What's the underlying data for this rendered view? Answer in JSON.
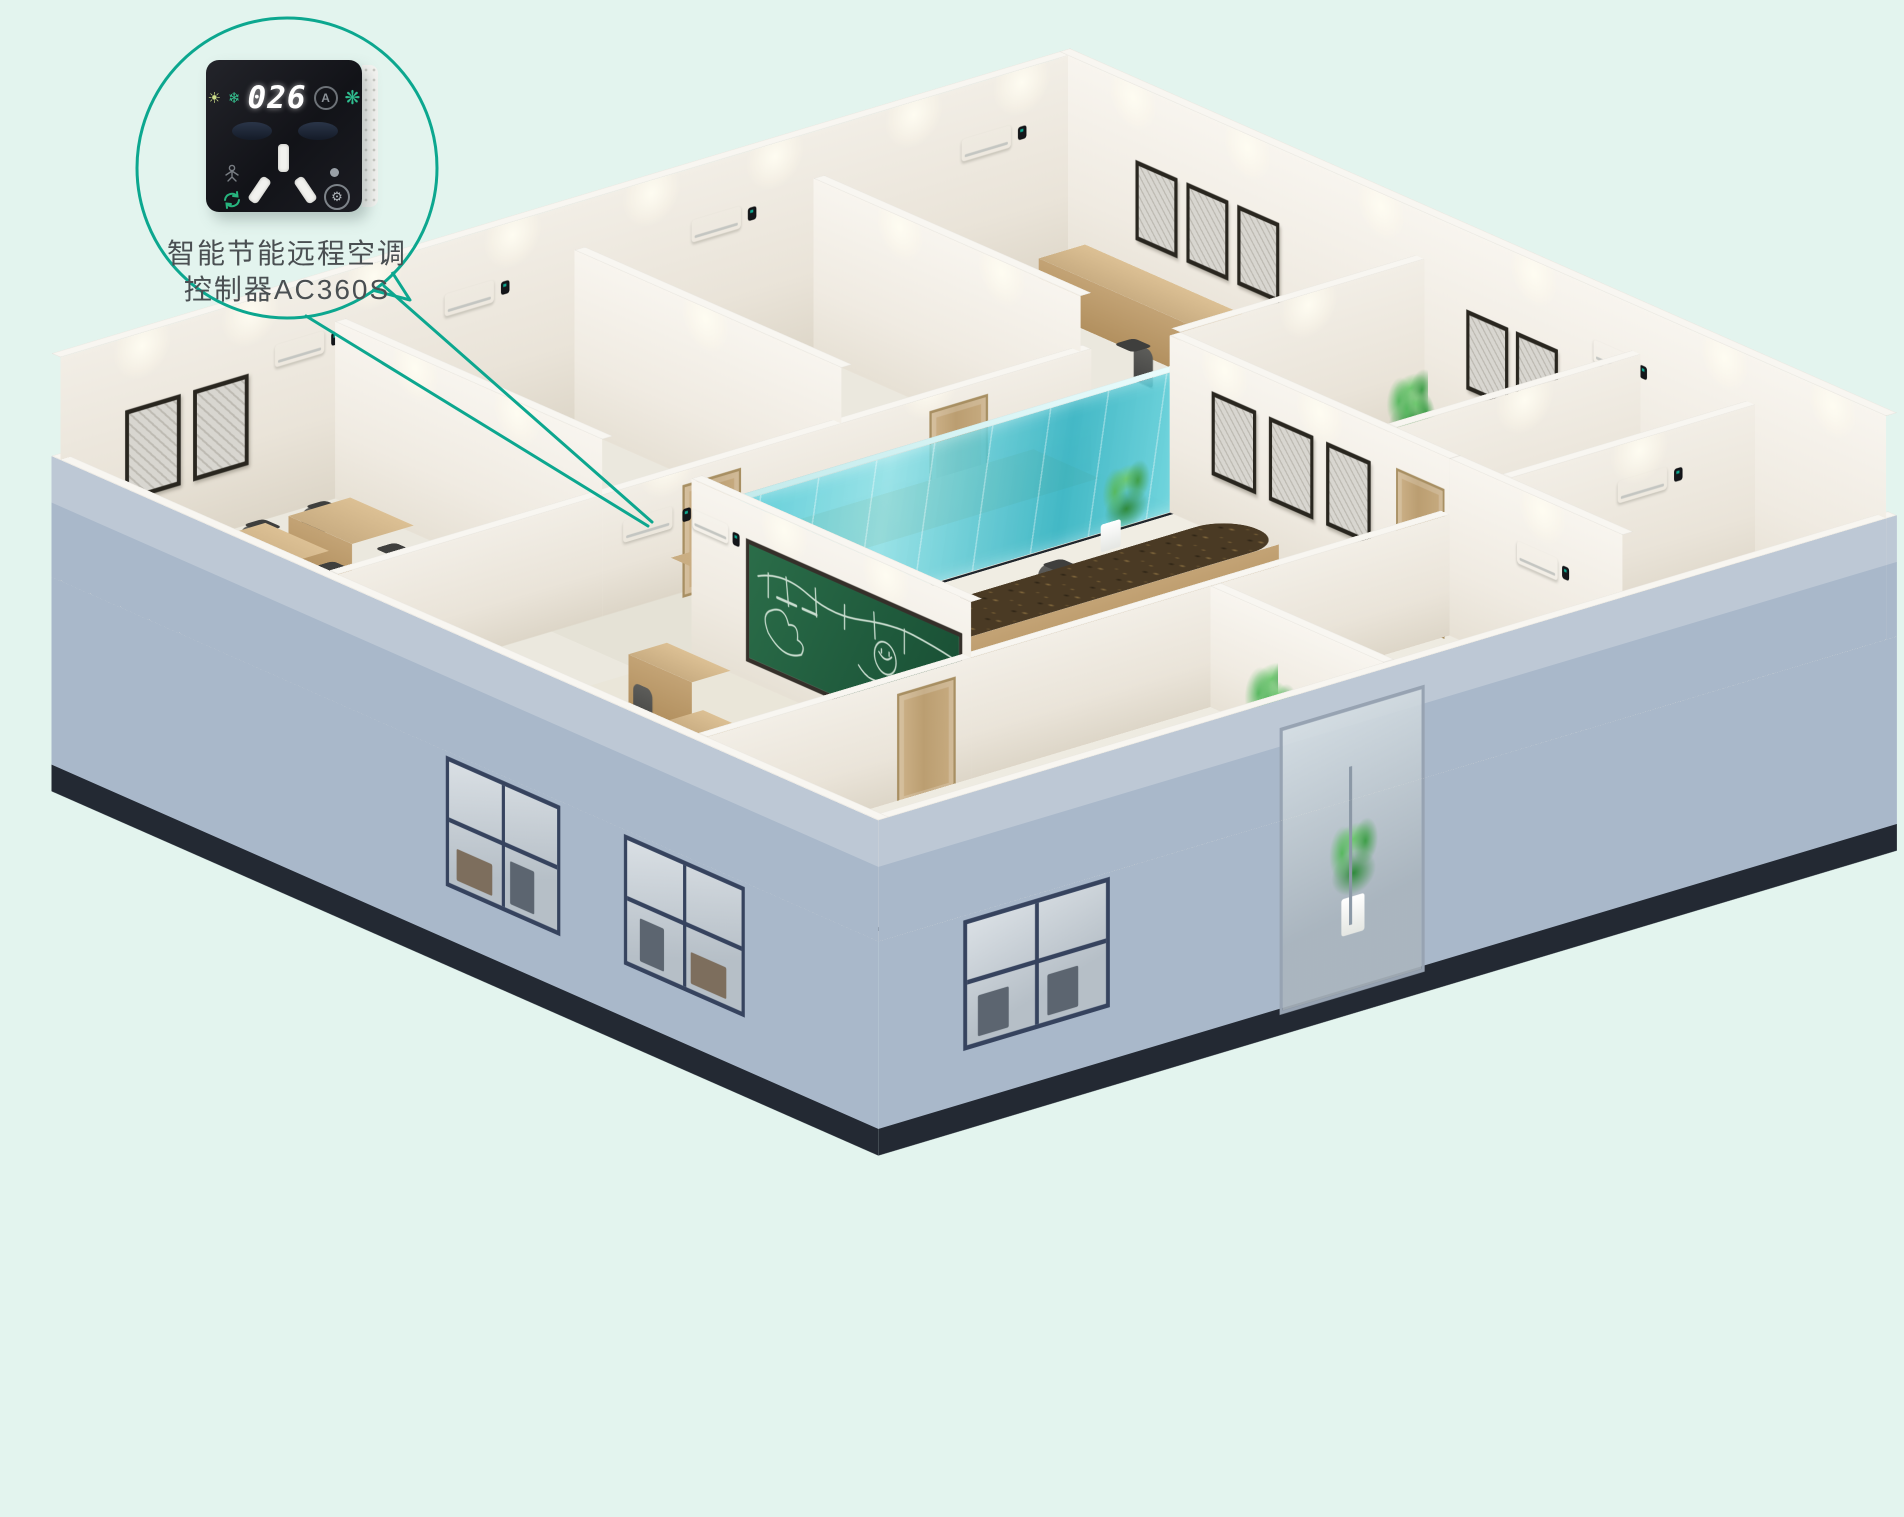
{
  "callout": {
    "label_line1": "智能节能远程空调",
    "label_line2": "控制器AC360S"
  },
  "device": {
    "display_value": "026",
    "auto_badge": "A",
    "icons": [
      "sun-icon",
      "snowflake-icon",
      "auto-mode-icon",
      "fan-icon",
      "presence-icon",
      "sync-icon",
      "status-led",
      "settings-gear-icon"
    ],
    "socket": "3-pin-socket"
  },
  "colors": {
    "accent": "#0ca78f",
    "bg": "#e3f4ee",
    "ext": "#a9b8ca",
    "ext-light": "#bdc8d5",
    "plinth": "#232933",
    "floor": "#ebe8de",
    "glass": "#35bfcd",
    "board": "#1f5a3c",
    "wood": "#c9ad82",
    "wood-dark": "#b2905f",
    "marble": "#4a3a24",
    "chair": "#454543",
    "plant": "#2f8a3b",
    "device": "#121318"
  }
}
